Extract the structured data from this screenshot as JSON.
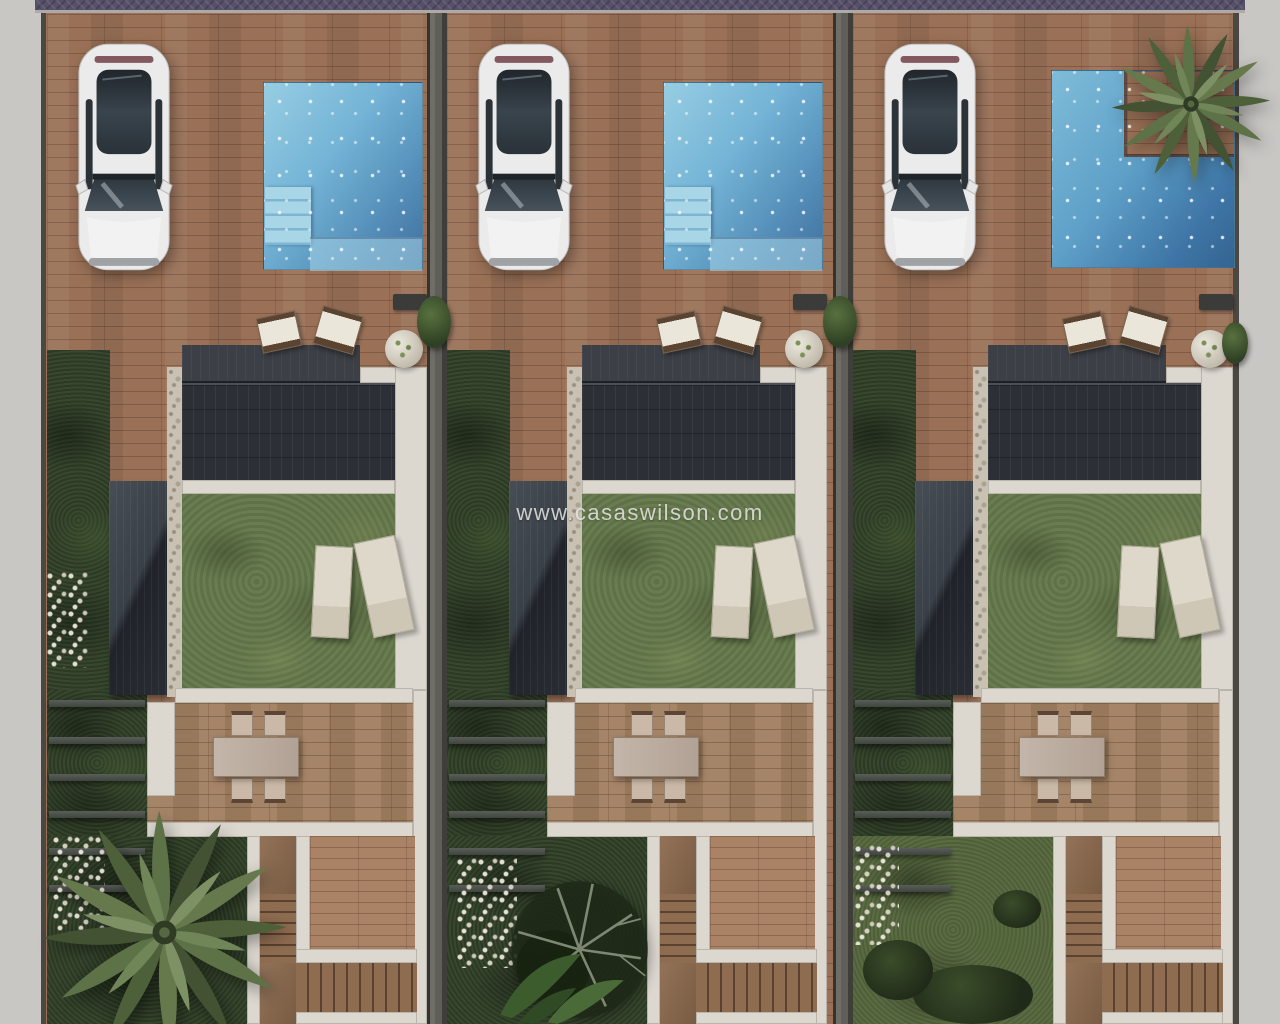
{
  "watermark": {
    "text": "www.casaswilson.com"
  },
  "scene": {
    "type": "3d-architectural-render-top-view",
    "subject": "Three attached villas, each with parking terrace, private pool, lawn, dining terrace and garden stairs",
    "units_count": 3
  },
  "palette": {
    "terracotta_paving": "#9a7157",
    "pool_water_light": "#97cde2",
    "pool_water_deep": "#416f9f",
    "lawn_green": "#64774a",
    "garden_dark_green": "#31402a",
    "roof_charcoal": "#2c3036",
    "path_white": "#dcd8d0",
    "sidewalk_gray": "#c9c7c4",
    "stone_wall": "#c9c2b3",
    "car_white": "#ebebeb",
    "lounger_cream": "#ddd8ca",
    "stair_wood": "#8e6c50"
  },
  "units": [
    {
      "id": "villa-1",
      "pool": "rectangular pool with corner steps and shelf",
      "vehicle": "white car parked",
      "garden_feature": "large palm tree over bottom garden"
    },
    {
      "id": "villa-2",
      "pool": "rectangular pool with corner steps and shelf",
      "vehicle": "white car parked",
      "garden_feature": "bare tree and banana plants in bottom garden"
    },
    {
      "id": "villa-3",
      "pool": "L-shaped pool with corner planter palm",
      "vehicle": "white car parked",
      "garden_feature": "moss garden with shrubs"
    }
  ]
}
